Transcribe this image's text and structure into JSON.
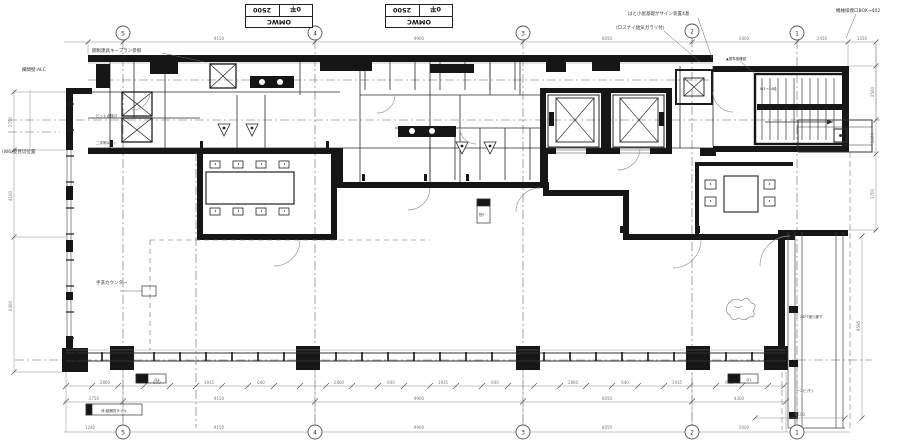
{
  "title_tables": [
    {
      "dim": "2500",
      "grade": "0平",
      "name": "OMWC"
    },
    {
      "dim": "2500",
      "grade": "0平",
      "name": "OMWC"
    }
  ],
  "grid": {
    "top": [
      "5",
      "4",
      "3",
      "2",
      "1"
    ],
    "bottom": [
      "5",
      "4",
      "3",
      "2",
      "1"
    ]
  },
  "dims": {
    "top": [
      "9150",
      "9900",
      "8050",
      "5000",
      "2450",
      "1350"
    ],
    "bottom1": [
      "2860",
      "640",
      "1935",
      "640",
      "2860",
      "640",
      "1935",
      "640",
      "2860",
      "640",
      "1935",
      "640"
    ],
    "bottom2": [
      "2750",
      "9150",
      "9900",
      "8050",
      "4300"
    ],
    "bottom3": [
      "1240",
      "9150",
      "9900",
      "8050",
      "5000"
    ],
    "left": [
      "2750",
      "4100",
      "6400"
    ],
    "right": [
      "2500",
      "1600",
      "3700"
    ],
    "right_lower_v": "9595",
    "right_lower_h": "6100"
  },
  "annotations": [
    {
      "text": "鋼製建具キープラン参照"
    },
    {
      "text": "欄間壁:ALC"
    },
    {
      "text": "(W6)壁見切位置"
    },
    {
      "text": "手洗カウンター"
    },
    {
      "text": "ピット点検口"
    },
    {
      "text": "二次側ルート"
    },
    {
      "text": "はと小屋基礎がサイン装置4基"
    },
    {
      "text": "(ロスナイ給気ガラリ付)"
    },
    {
      "text": "▲基準墨確認"
    },
    {
      "text": "W1→14段"
    },
    {
      "text": "機械排煙口BOX→402"
    },
    {
      "text": "担F"
    },
    {
      "text": "2SFT渡り廊下"
    },
    {
      "text": "ーニビ(干)"
    },
    {
      "text": "床:磁器質タイル"
    },
    {
      "text": "G1"
    },
    {
      "text": "G1"
    }
  ]
}
